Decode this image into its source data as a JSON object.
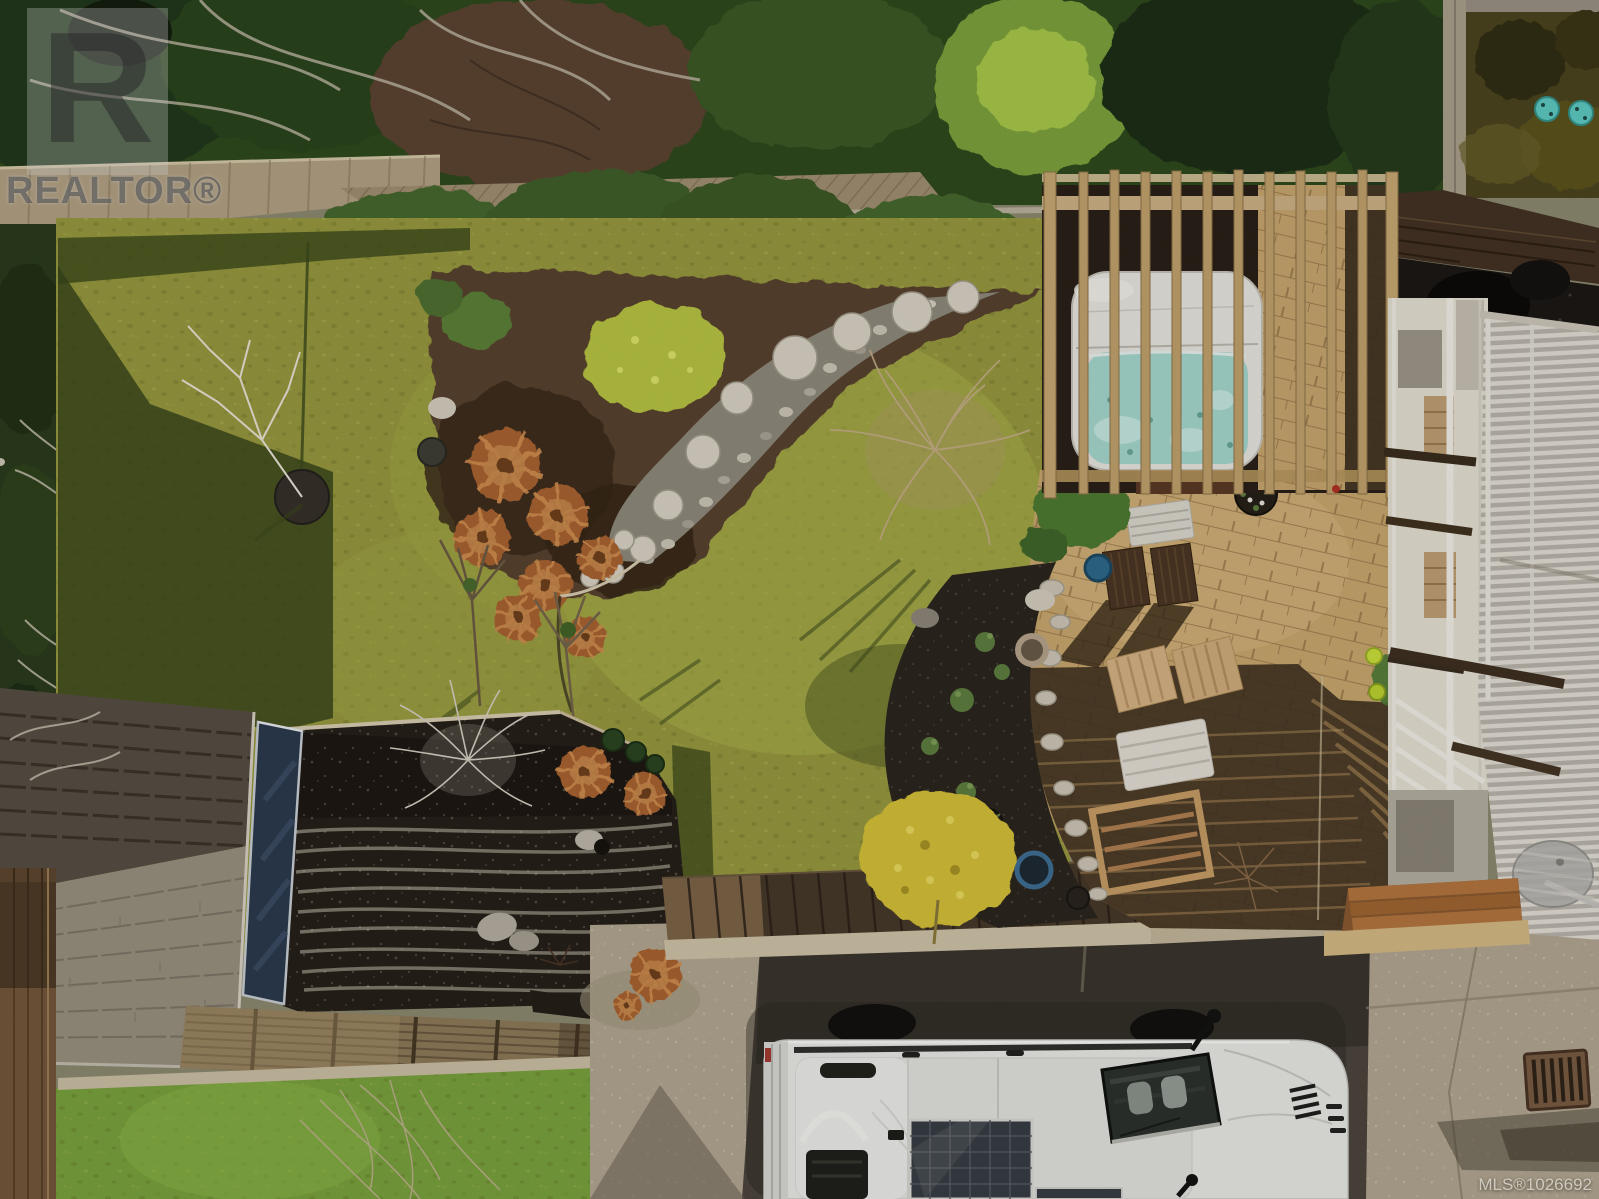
{
  "image": {
    "kind": "aerial drone photograph",
    "subject": "top-down view of a backyard: lawn with rock garden, hot tub under pergola slats, brick patio with wooden furniture, shed roof, gravel beds, and a white camper van with rooftop solar panel on the driveway",
    "width_px": 1599,
    "height_px": 1199
  },
  "watermarks": {
    "logo_letter": "R",
    "logo_text": "REALTOR®",
    "mls_text": "MLS®1026692"
  },
  "palette": {
    "lawn_sun": "#a8b14c",
    "lawn_shade": "#39471b",
    "hedge_green": "#415f2a",
    "brick_patio": "#c9a76f",
    "patio_shadow": "#3a2b1d",
    "pergola_wood": "#c2a36d",
    "hot_tub_water": "#a6d8ce",
    "van_body": "#e9e9e5",
    "solar_panel": "#383d44",
    "driveway_concrete": "#b1a691",
    "asphalt": "#4c463d",
    "shed_roof_sun": "#99917f",
    "shed_roof_shade": "#574f45",
    "shed_door_navy": "#2c3a4d",
    "soil_bed": "#2c261f",
    "rust_grass": "#a96332",
    "yellow_bush": "#d6c138",
    "teal_utility_covers": "#5ec9c2"
  }
}
